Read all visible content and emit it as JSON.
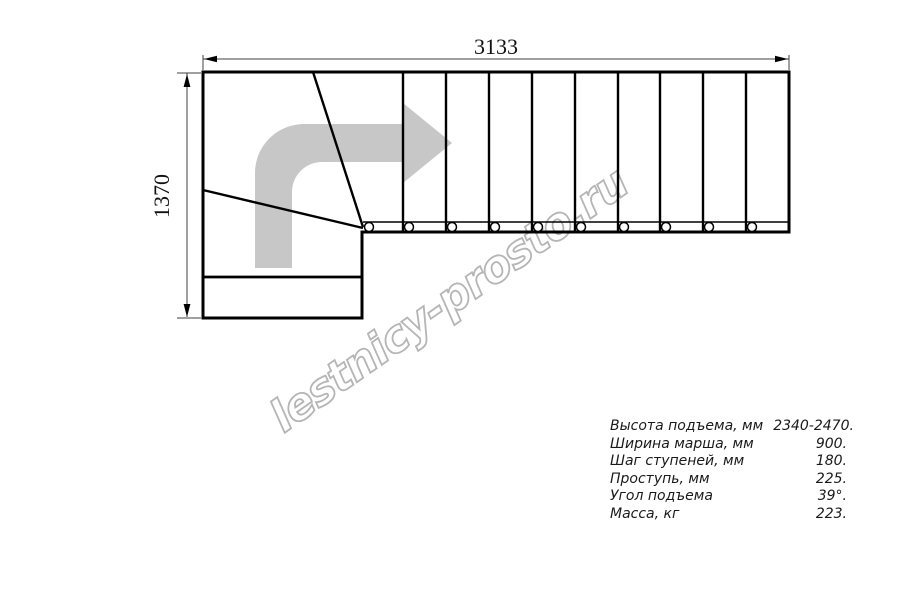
{
  "drawing": {
    "top_dimension_label": "3133",
    "left_dimension_label": "1370"
  },
  "watermark_text": "lestnicy-prosto.ru",
  "specs": [
    {
      "label": "Высота подъема, мм",
      "value": "2340-2470."
    },
    {
      "label": "Ширина марша, мм",
      "value": "900."
    },
    {
      "label": "Шаг ступеней, мм",
      "value": "180."
    },
    {
      "label": "Проступь, мм",
      "value": "225."
    },
    {
      "label": "Угол подъема",
      "value": "39°."
    },
    {
      "label": "Масса, кг",
      "value": "223."
    }
  ],
  "colors": {
    "line": "#000000",
    "dimension_line": "#404040",
    "arrow_fill": "#c7c7c7",
    "watermark": "#b5b5b5"
  }
}
